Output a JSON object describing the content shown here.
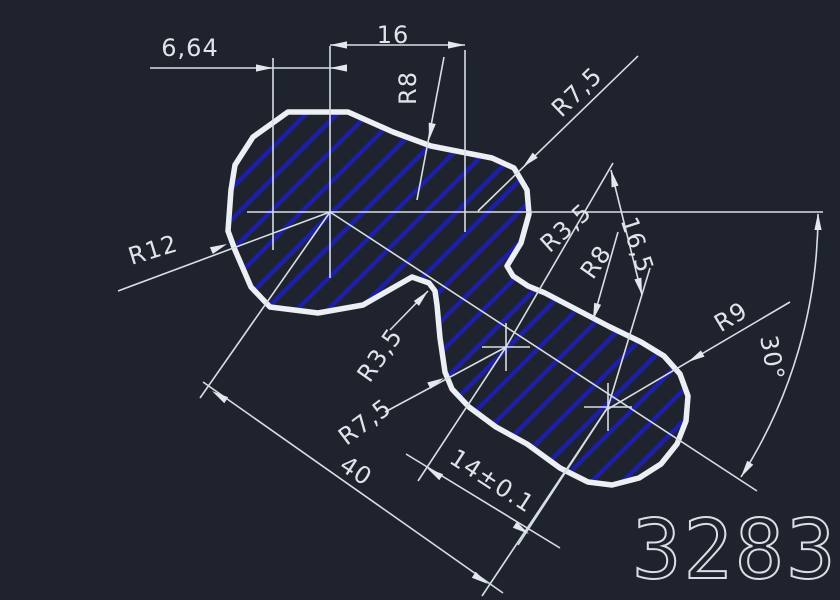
{
  "drawing": {
    "title": "CAD part drawing",
    "part_number": "3283",
    "colors": {
      "background": "#1f232d",
      "thin_line": "#d8dee6",
      "outline": "#eceff4",
      "hatch": "#1d1fa6",
      "text": "#dfe4ea"
    },
    "labels": {
      "dim_664": {
        "text": "6,64"
      },
      "dim_16": {
        "text": "16"
      },
      "r8_top": {
        "text": "R8"
      },
      "r75_top": {
        "text": "R7,5"
      },
      "r12": {
        "text": "R12"
      },
      "r35_right": {
        "text": "R3,5"
      },
      "r8_mid": {
        "text": "R8"
      },
      "dim_165": {
        "text": "16,5"
      },
      "r35_left": {
        "text": "R3,5"
      },
      "r75_left": {
        "text": "R7,5"
      },
      "dim_40": {
        "text": "40"
      },
      "dim_14": {
        "text": "14±0.1"
      },
      "r9": {
        "text": "R9"
      },
      "angle_30": {
        "text": "30°"
      }
    }
  }
}
